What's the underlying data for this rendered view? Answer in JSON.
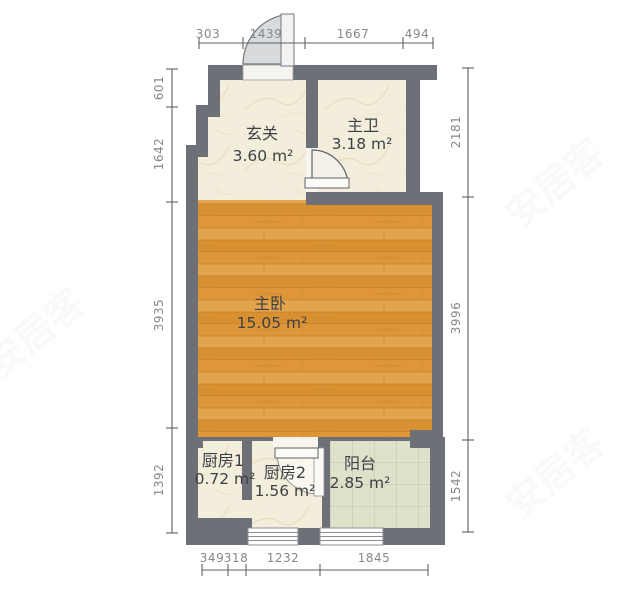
{
  "watermark_text": "安居客",
  "rooms": {
    "xuanguan": {
      "name": "玄关",
      "area": "3.60 m²"
    },
    "zhuwei": {
      "name": "主卫",
      "area": "3.18 m²"
    },
    "zhuwo": {
      "name": "主卧",
      "area": "15.05 m²"
    },
    "chufang1": {
      "name": "厨房1",
      "area": "0.72 m²"
    },
    "chufang2": {
      "name": "厨房2",
      "area": "1.56 m²"
    },
    "yangtai": {
      "name": "阳台",
      "area": "2.85 m²"
    }
  },
  "dimensions": {
    "top": [
      "303",
      "1439",
      "1667",
      "494"
    ],
    "left": [
      "601",
      "1642",
      "3935",
      "1392"
    ],
    "right": [
      "2181",
      "3996",
      "1542"
    ],
    "bottom": [
      "349",
      "318",
      "1232",
      "1845"
    ]
  },
  "colors": {
    "wall": "#6d7177",
    "marble_floor": "#f3eedb",
    "wood_floor": "#e09c40",
    "tile_floor": "#dfe2ca",
    "dimension_line": "#5d6266",
    "dimension_text": "#84898e",
    "room_label": "#3d4145",
    "door_fill": "#dcdddd"
  }
}
